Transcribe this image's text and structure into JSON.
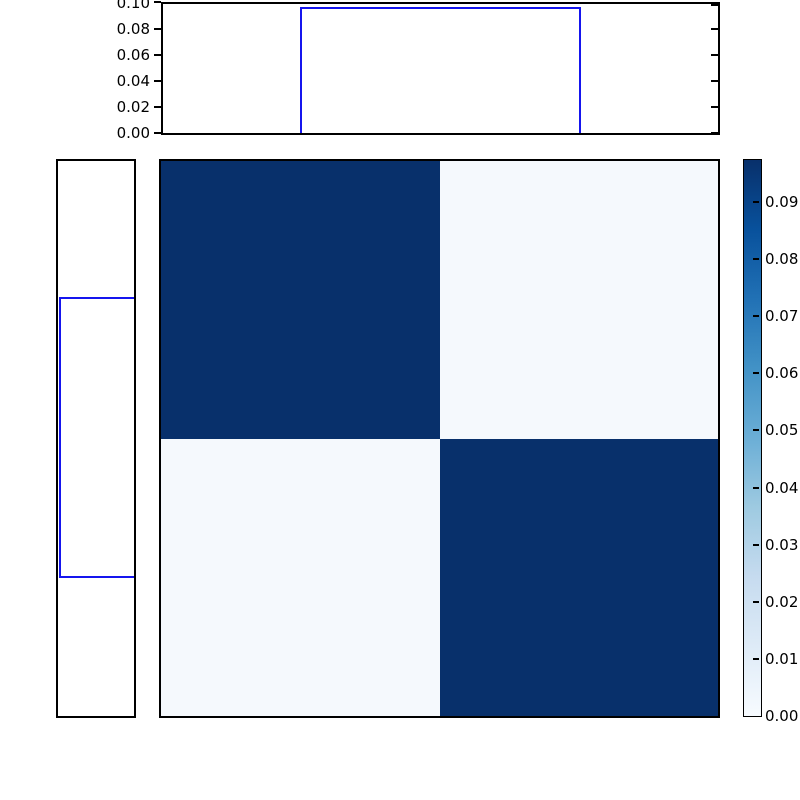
{
  "chart_data": {
    "type": "heatmap",
    "title": "",
    "xlabel": "",
    "ylabel": "",
    "heatmap": {
      "rows": 2,
      "cols": 2,
      "matrix": [
        [
          0.097,
          0.003
        ],
        [
          0.003,
          0.097
        ]
      ],
      "colormap": "Blues",
      "vmin": 0.0,
      "vmax": 0.097,
      "colors": {
        "high": "#08306b",
        "low": "#f5f9fd"
      }
    },
    "top_marginal": {
      "type": "step-histogram",
      "orientation": "vertical",
      "line_color": "#1515ee",
      "ylim": [
        0.0,
        0.1
      ],
      "yticks": [
        "0.00",
        "0.02",
        "0.04",
        "0.06",
        "0.08",
        "0.10"
      ],
      "bar": {
        "start_frac": 0.25,
        "end_frac": 0.75,
        "height": 0.097
      }
    },
    "left_marginal": {
      "type": "step-histogram",
      "orientation": "horizontal",
      "line_color": "#1515ee",
      "xlim_inverted": [
        0.1,
        0.0
      ],
      "bar": {
        "start_frac": 0.25,
        "end_frac": 0.75,
        "length": 0.097
      }
    },
    "colorbar": {
      "position": "right",
      "ticks": [
        "0.00",
        "0.01",
        "0.02",
        "0.03",
        "0.04",
        "0.05",
        "0.06",
        "0.07",
        "0.08",
        "0.09"
      ],
      "gradient": [
        "#f7fbff",
        "#deebf7",
        "#c6dbef",
        "#9ecae1",
        "#6baed6",
        "#4292c6",
        "#2171b5",
        "#08519c",
        "#08306b"
      ]
    }
  }
}
